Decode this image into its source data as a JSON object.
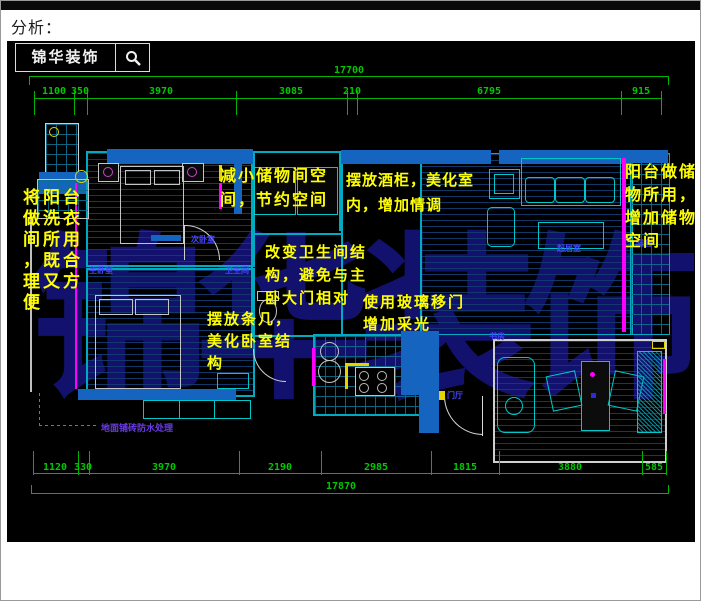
{
  "header": {
    "title": "分析："
  },
  "logo": {
    "text": "锦华装饰",
    "icon": "magnifier-icon"
  },
  "watermark": {
    "text": "锦华装饰"
  },
  "palette": {
    "background": "#000000",
    "dimension_green": "#00b400",
    "annotation_yellow": "#ffff00",
    "wall_teal": "#00aac0",
    "wall_fill_blue": "#1464c0",
    "window_magenta": "#ff00ff",
    "watermark_navy": "#12126e",
    "room_label_blue": "#4646ff"
  },
  "dimensions": {
    "top": {
      "overall": "17700",
      "segments": [
        "1100",
        "350",
        "3970",
        "3085",
        "210",
        "6795",
        "915"
      ]
    },
    "bottom": {
      "overall": "17870",
      "segments": [
        "1120",
        "330",
        "3970",
        "2190",
        "2985",
        "1815",
        "3880",
        "585"
      ]
    }
  },
  "annotations": {
    "laundry": {
      "lines": [
        "将阳台",
        "做洗衣",
        "间所用",
        "，既合",
        "理又方",
        "便"
      ]
    },
    "storage_small": {
      "lines": [
        "减小储物间空",
        "间，节约空间"
      ]
    },
    "wine_cabinet": {
      "lines": [
        "摆放酒柜，美化室",
        "内，增加情调"
      ]
    },
    "bathroom": {
      "lines": [
        "改变卫生间结",
        "构，避免与主",
        "卧大门相对"
      ]
    },
    "console_table": {
      "lines": [
        "摆放条几，",
        "美化卧室结",
        "构"
      ]
    },
    "glass_door": {
      "lines": [
        "使用玻璃移门",
        "增加采光"
      ]
    },
    "balcony_storage": {
      "lines": [
        "阳台做储",
        "物所用，",
        "增加储物",
        "空间"
      ]
    }
  },
  "room_labels": {
    "bedroom_secondary": "次卧室",
    "bedroom_master": "主卧室",
    "bathroom": "卫生间",
    "living": "起居室",
    "entry": "门厅",
    "study": "书房",
    "balcony": "阳台"
  },
  "leader_note": {
    "text": "地面铺砖防水处理"
  }
}
